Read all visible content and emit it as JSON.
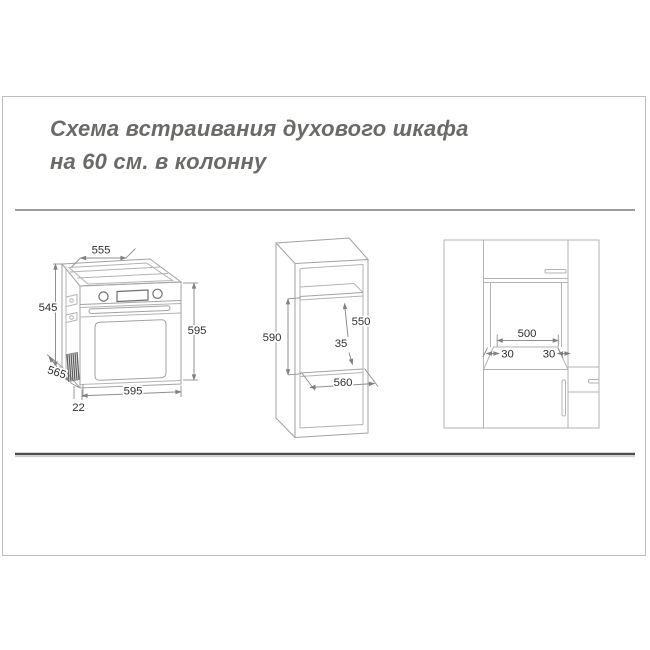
{
  "title": {
    "line1": "Схема встраивания духового шкафа",
    "line2": "на 60 см. в колонну"
  },
  "oven_view": {
    "description": "isometric view of built-in oven",
    "dims": {
      "top_width": "555",
      "rear_height": "545",
      "depth": "565",
      "front_height": "595",
      "front_width": "595",
      "front_offset": "22"
    }
  },
  "column_view": {
    "description": "isometric view of tall cabinet column with oven niche",
    "dims": {
      "niche_height": "590",
      "niche_depth": "550",
      "rear_gap": "35",
      "niche_width": "560"
    }
  },
  "facade_view": {
    "description": "front view of kitchen column with oven opening",
    "dims": {
      "opening_width": "500",
      "margin_left": "30",
      "margin_right": "30"
    }
  },
  "colors": {
    "drawing_line": "#a2a2a2",
    "dim_text": "#2f2f2f",
    "title_text": "#6b6a68",
    "rule_top": "#7d7d7d",
    "rule_bottom": "#4f4f4f",
    "frame_border": "#bdbdbd"
  }
}
